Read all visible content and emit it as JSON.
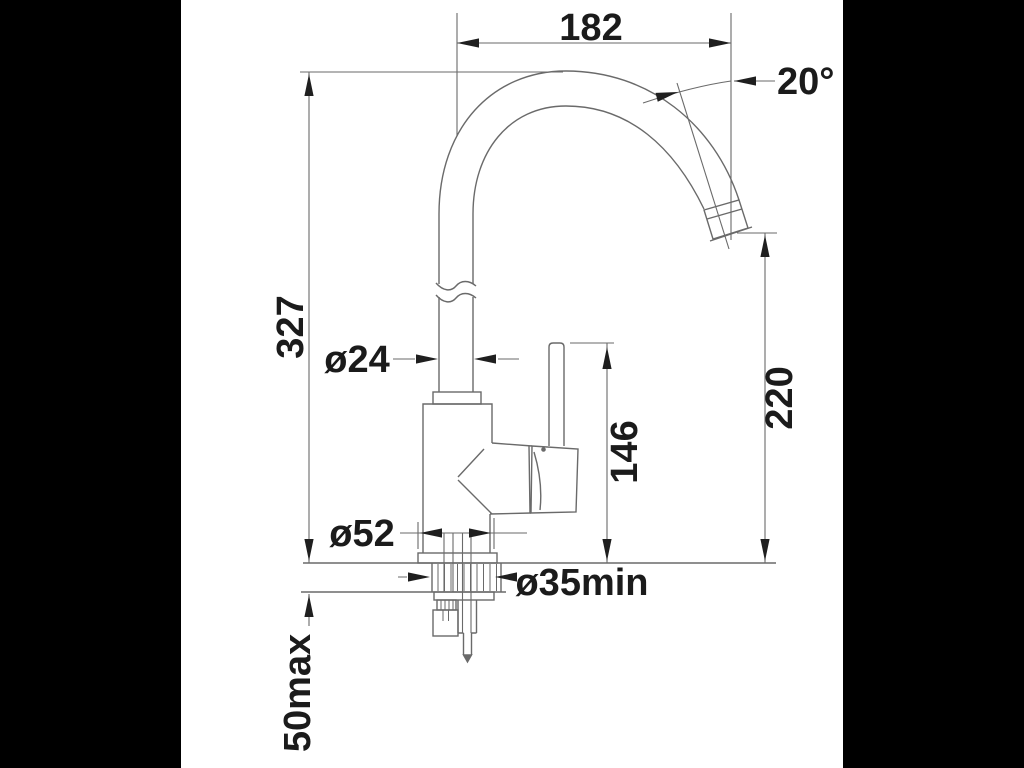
{
  "window": {
    "background": "#000000",
    "paper_color": "#ffffff",
    "line_color": "#6a6a6a",
    "label_color": "#1b1b1b"
  },
  "drawing": {
    "subject": "kitchen-mixer-tap-side-elevation",
    "labels": {
      "spout_reach": "182",
      "spout_angle": "20°",
      "overall_height": "327",
      "spout_tube_diameter": "ø24",
      "outlet_height": "220",
      "handle_height": "146",
      "base_diameter": "ø52",
      "mounting_hole": "ø35min",
      "deck_thickness": "50max"
    }
  }
}
